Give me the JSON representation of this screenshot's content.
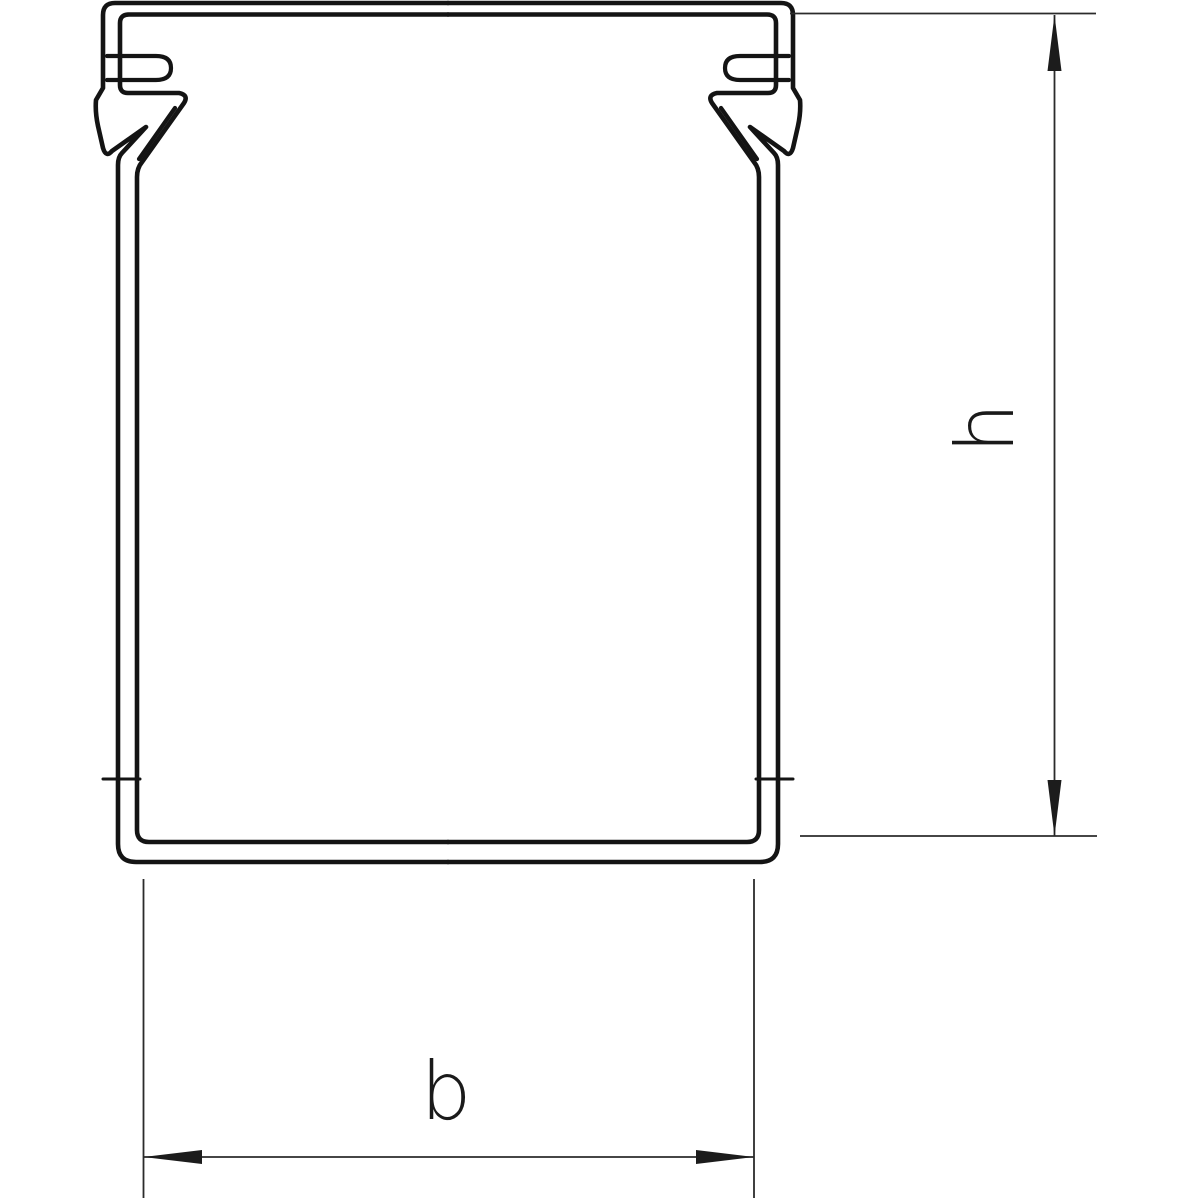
{
  "drawing": {
    "type": "technical-cross-section",
    "subject": "Cable trunking profile cross-section with snap-in cover clips and dimension lines",
    "background": "#ffffff"
  },
  "colors": {
    "profile_line": "#141414",
    "dimension_line": "#2b2b2b",
    "arrow_fill": "#1c1c1c",
    "label": "#1a1a1a"
  },
  "dimensions": {
    "height": {
      "label": "h"
    },
    "width": {
      "label": "b"
    }
  }
}
